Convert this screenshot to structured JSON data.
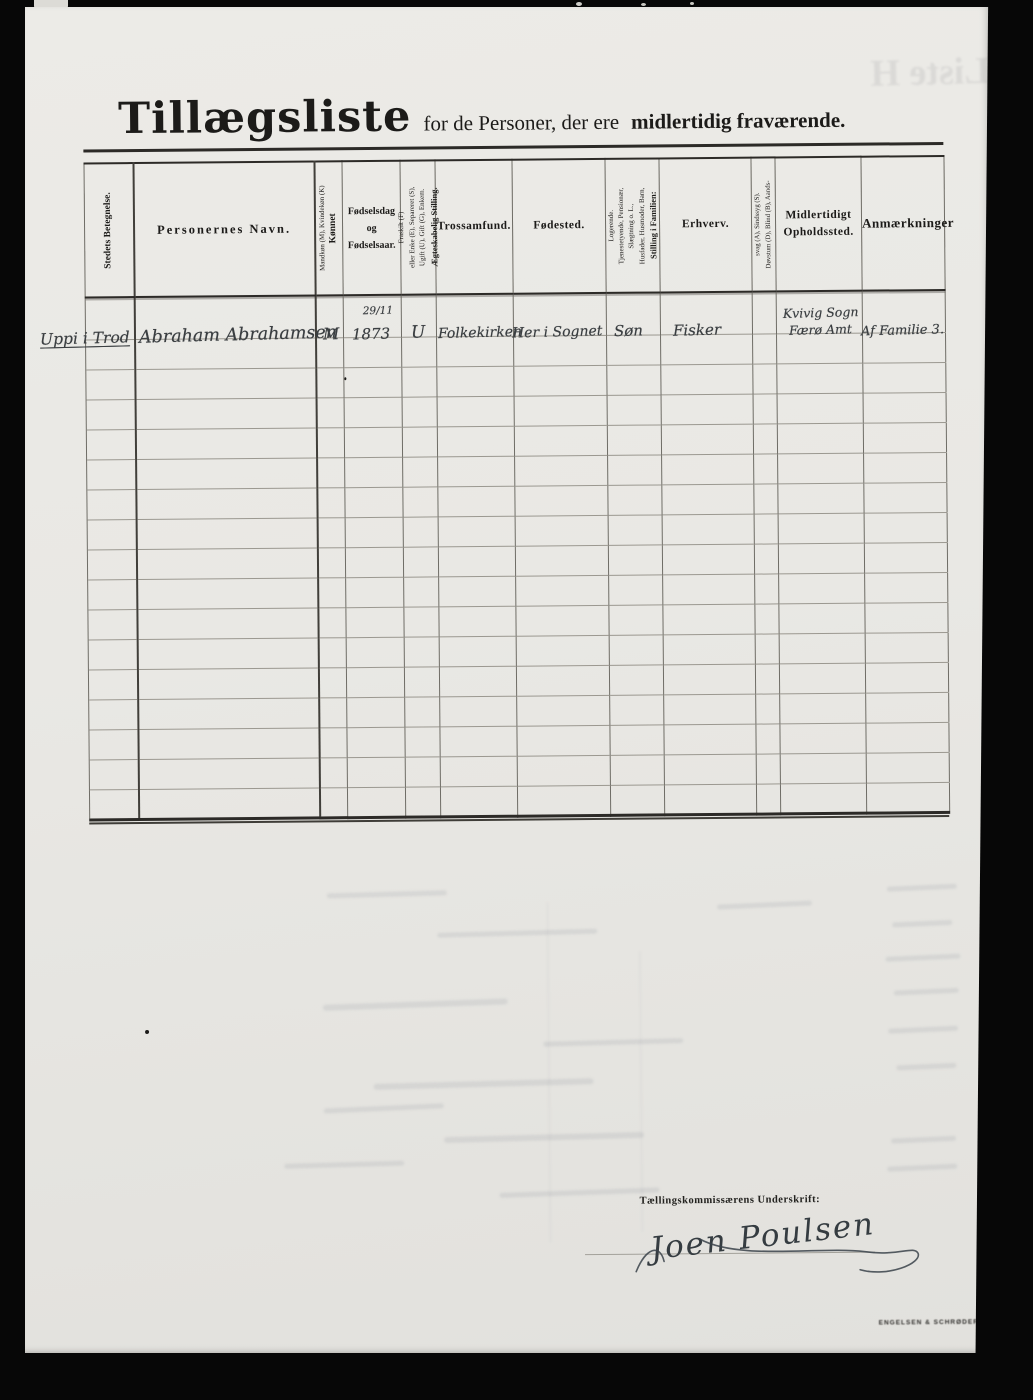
{
  "colors": {
    "paper": "#e9e8e4",
    "ink": "#1c1b19",
    "hand": "#3a3e41"
  },
  "ghost_title": "Liste H",
  "title": {
    "main": "Tillægsliste",
    "rest_regular": "for de Personer, der ere",
    "rest_bold": "midlertidig fraværende."
  },
  "table": {
    "columns": [
      {
        "label": "Stedets Betegnelse."
      },
      {
        "label": "Personernes Navn."
      },
      {
        "label": "Kønnet",
        "sub": "Mandkøn (M), Kvindekøn (K)"
      },
      {
        "lines": [
          "Fødselsdag",
          "og",
          "Fødselsaar."
        ]
      },
      {
        "label": "Ægteskabelig Stilling.",
        "sub_lines": [
          "Ugift (U), Gift (G), Enkem.",
          "eller Enke (E), Separeret (S),",
          "Fraskilt (F)"
        ]
      },
      {
        "label": "Trossamfund."
      },
      {
        "label": "Fødested."
      },
      {
        "label": "Stilling i Familien:",
        "sub_lines": [
          "Husfader, Husmoder, Barn,",
          "Slægtning o. L.,",
          "Tjenestetyende, Pensionær,",
          "Logerende."
        ]
      },
      {
        "label": "Erhverv."
      },
      {
        "lines": [
          "Døvstum (D), Blind (B), Aands-",
          "svag (A), Sindssyg (S)."
        ]
      },
      {
        "lines": [
          "Midlertidigt",
          "Opholdssted."
        ]
      },
      {
        "label": "Anmærkninger"
      }
    ],
    "entry": {
      "sted": "Uppi i Trod",
      "navn": "Abraham Abrahamsen",
      "kon": "M",
      "fodsel_dag": "29/11",
      "fodsel_aar": "1873",
      "aegteskab": "U",
      "tro": "Folkekirken",
      "fodested": "Her i Sognet",
      "familie": "Søn",
      "erhverv": "Fisker",
      "ophold_line1": "Kvivig Sogn",
      "ophold_line2": "Færø Amt",
      "anm": "Af Familie 3."
    },
    "empty_rows": 16
  },
  "footer": {
    "signature_label": "Tællingskommissærens Underskrift:",
    "signature": "Joen Poulsen",
    "printer_mark": "ENGELSEN & SCHRØDER"
  }
}
